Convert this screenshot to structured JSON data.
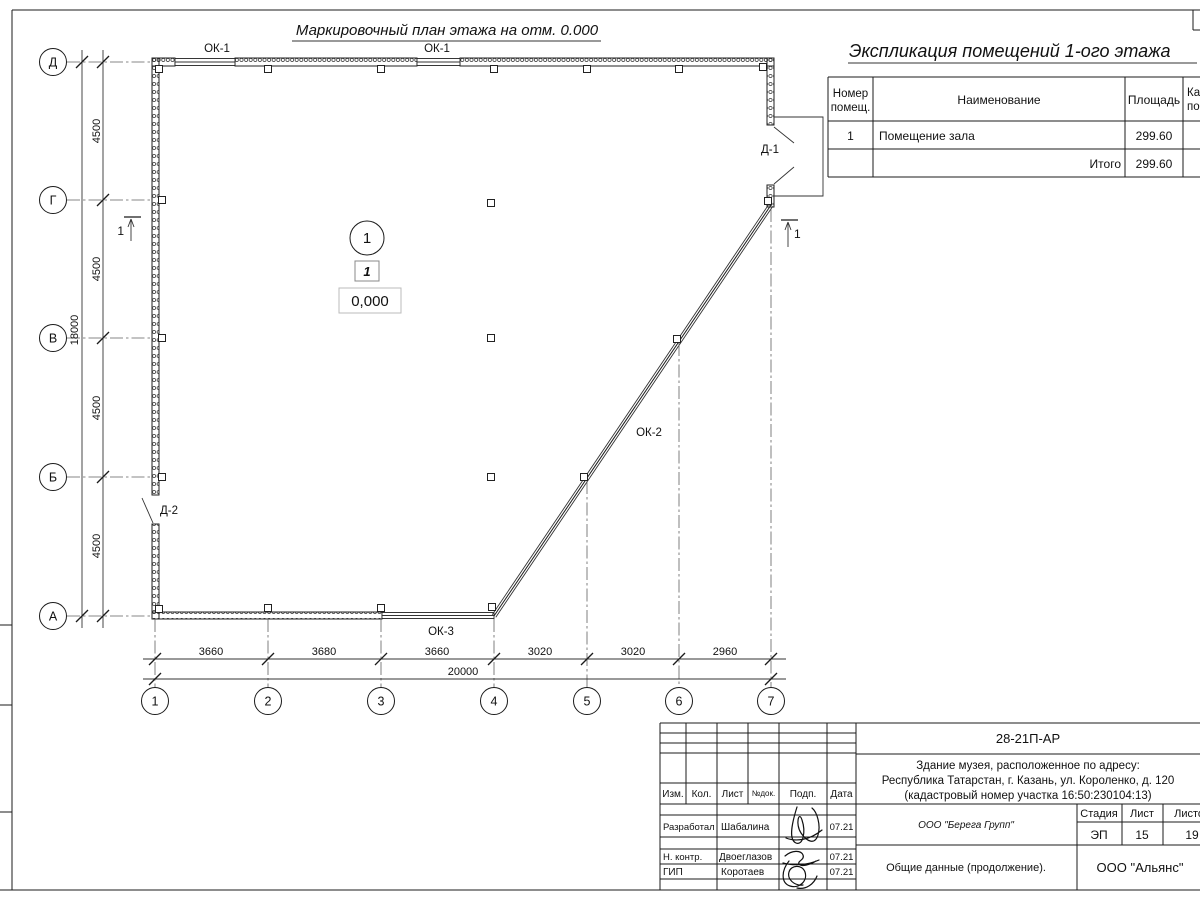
{
  "plan": {
    "title": "Маркировочный план этажа на отм. 0.000",
    "axis_rows": [
      "Д",
      "Г",
      "В",
      "Б",
      "А"
    ],
    "axis_cols": [
      "1",
      "2",
      "3",
      "4",
      "5",
      "6",
      "7"
    ],
    "dims_left": [
      "4500",
      "4500",
      "4500",
      "4500"
    ],
    "dim_left_total": "18000",
    "dims_bottom": [
      "3660",
      "3680",
      "3660",
      "3020",
      "3020",
      "2960"
    ],
    "dim_bottom_total": "20000",
    "labels": {
      "ok1_a": "ОК-1",
      "ok1_b": "ОК-1",
      "ok2": "ОК-2",
      "ok3": "ОК-3",
      "d1": "Д-1",
      "d2": "Д-2",
      "section_left": "1",
      "section_right": "1",
      "room_circle": "1",
      "room_tag": "1",
      "elevation": "0,000"
    }
  },
  "explication": {
    "title": "Экспликация помещений 1-ого этажа",
    "header": {
      "number_l1": "Номер",
      "number_l2": "помещ.",
      "name": "Наименование",
      "area": "Площадь",
      "cat_l1": "Ка",
      "cat_l2": "по"
    },
    "rows": [
      {
        "number": "1",
        "name": "Помещение зала",
        "area": "299.60"
      }
    ],
    "total_label": "Итого",
    "total_area": "299.60"
  },
  "titleblock": {
    "doc_number": "28-21П-АР",
    "address_l1": "Здание музея, расположенное по адресу:",
    "address_l2": "Республика Татарстан, г. Казань, ул. Короленко, д. 120",
    "address_l3": "(кадастровый номер участка 16:50:230104:13)",
    "cols": [
      "Изм.",
      "Кол.",
      "Лист",
      "№док.",
      "Подп.",
      "Дата"
    ],
    "sign_rows": [
      {
        "role": "Разработал",
        "name": "Шабалина",
        "date": "07.21"
      },
      {
        "role": "Н. контр.",
        "name": "Двоеглазов",
        "date": "07.21"
      },
      {
        "role": "ГИП",
        "name": "Коротаев",
        "date": "07.21"
      }
    ],
    "company": "ООО \"Берега Групп\"",
    "stage_label": "Стадия",
    "sheet_label": "Лист",
    "sheets_label": "Листов",
    "stage": "ЭП",
    "sheet_num": "15",
    "sheets_num": "19",
    "doc_title": "Общие данные (продолжение).",
    "company2": "ООО \"Альянс\""
  }
}
